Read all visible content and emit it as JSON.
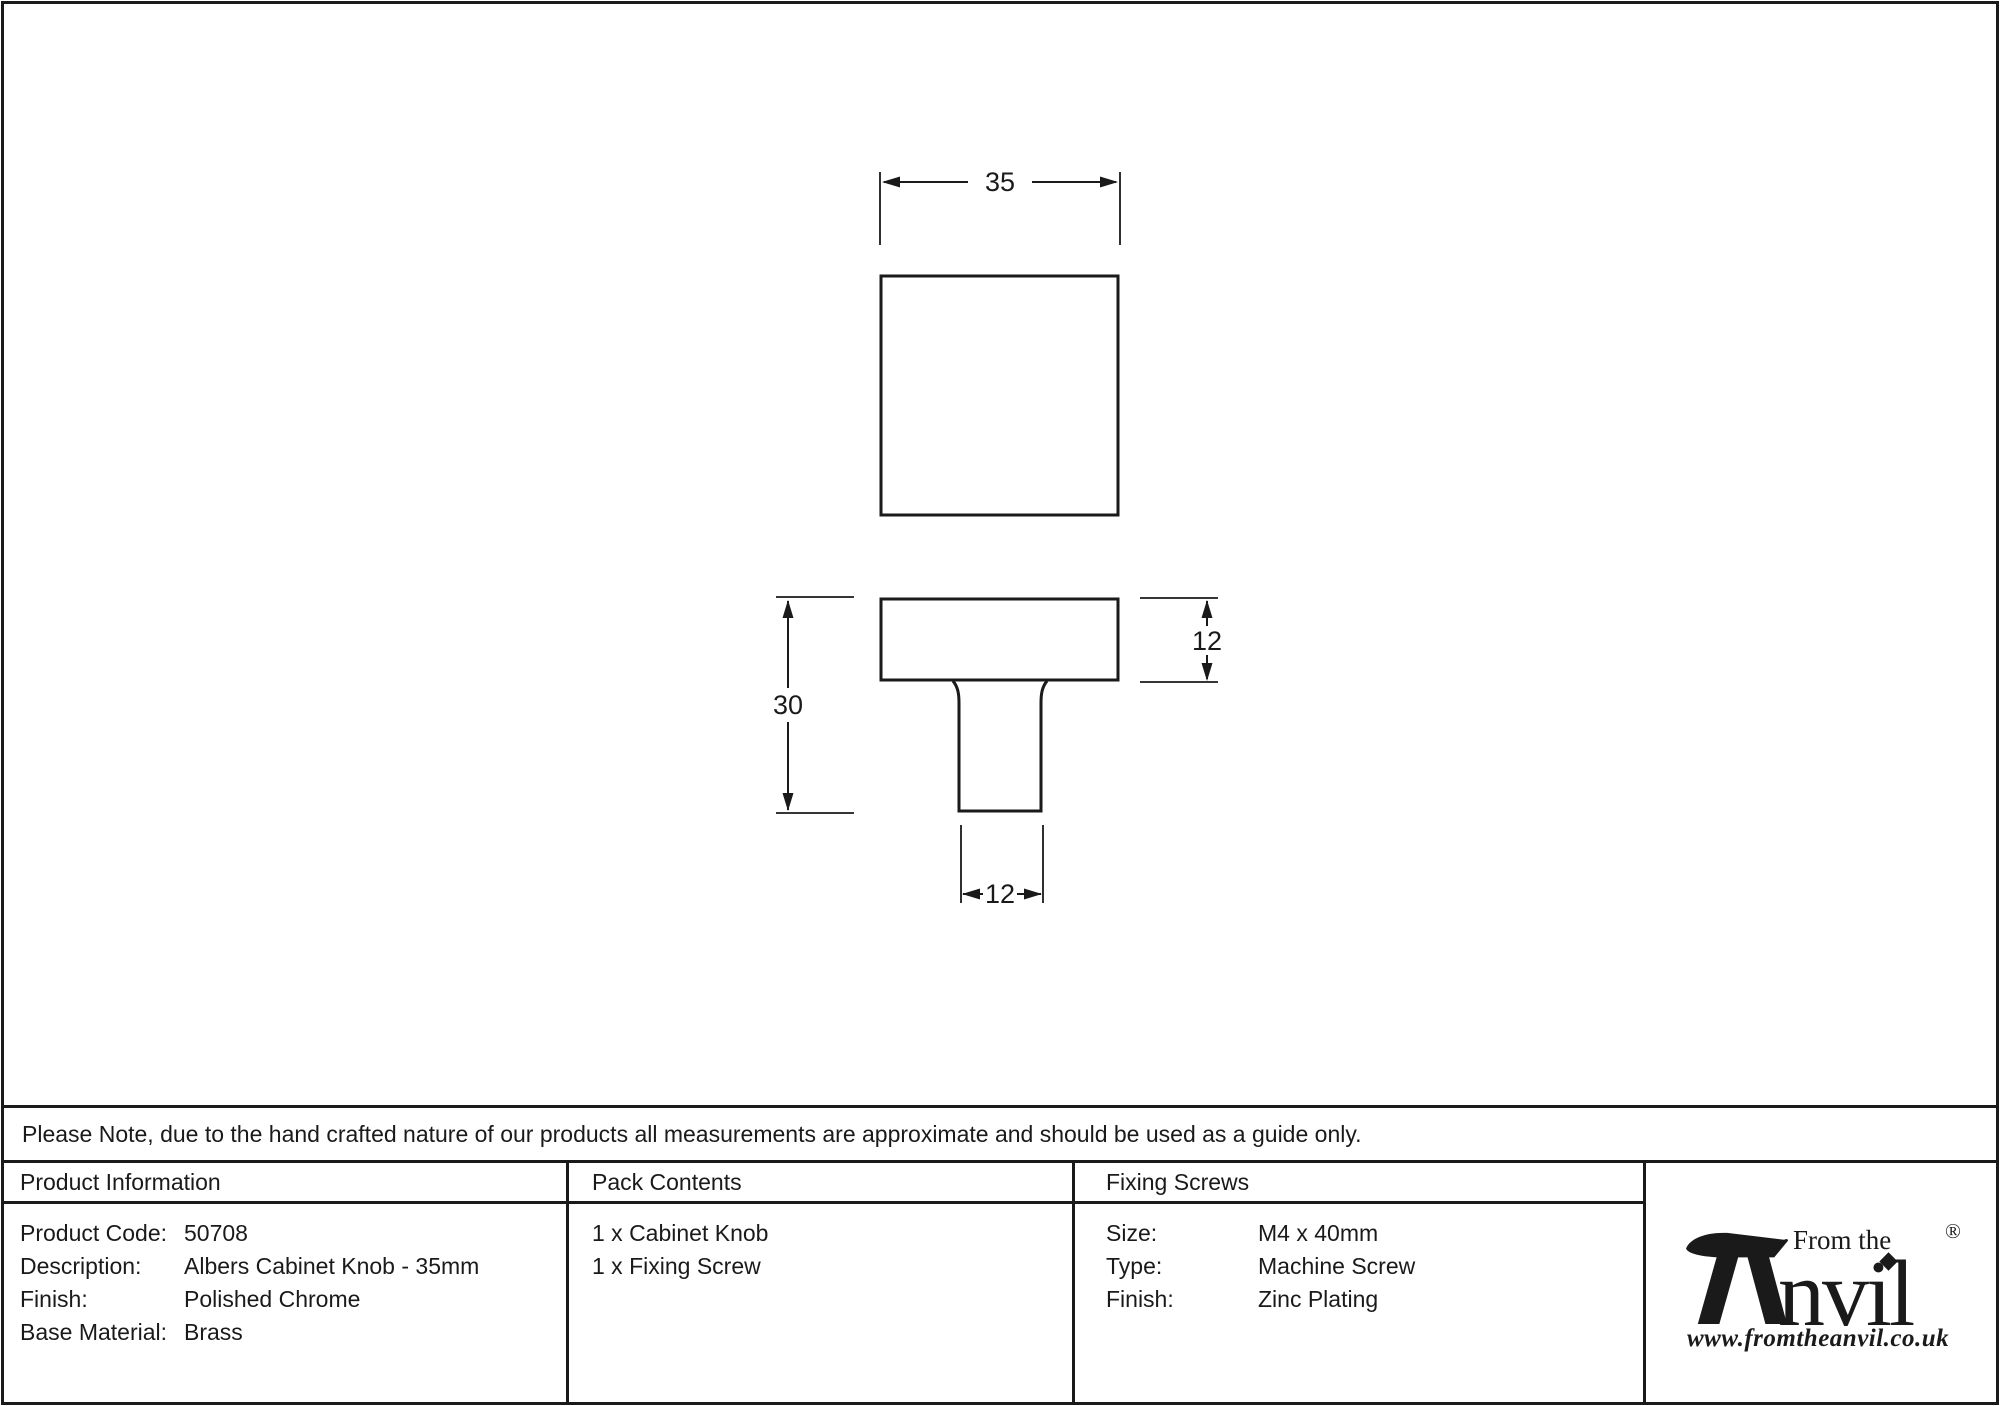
{
  "note": {
    "text": "Please Note, due to the hand crafted nature of our products all measurements are approximate and should be used as a guide only."
  },
  "drawing": {
    "dim_width": "35",
    "dim_total_height": "30",
    "dim_head_height": "12",
    "dim_stem_width": "12"
  },
  "product_information": {
    "header": "Product Information",
    "rows": [
      {
        "label": "Product Code:",
        "value": "50708"
      },
      {
        "label": "Description:",
        "value": "Albers Cabinet Knob - 35mm"
      },
      {
        "label": "Finish:",
        "value": "Polished Chrome"
      },
      {
        "label": "Base Material:",
        "value": "Brass"
      }
    ]
  },
  "pack_contents": {
    "header": "Pack Contents",
    "items": [
      "1 x Cabinet Knob",
      "1 x Fixing Screw"
    ]
  },
  "fixing_screws": {
    "header": "Fixing Screws",
    "rows": [
      {
        "label": "Size:",
        "value": "M4 x 40mm"
      },
      {
        "label": "Type:",
        "value": "Machine Screw"
      },
      {
        "label": "Finish:",
        "value": "Zinc Plating"
      }
    ]
  },
  "logo": {
    "top_text": "From the",
    "name": "Anvil",
    "name_rest": "nvil",
    "registered": "®",
    "url": "www.fromtheanvil.co.uk"
  },
  "colors": {
    "ink": "#1a1a1a",
    "background": "#ffffff"
  }
}
